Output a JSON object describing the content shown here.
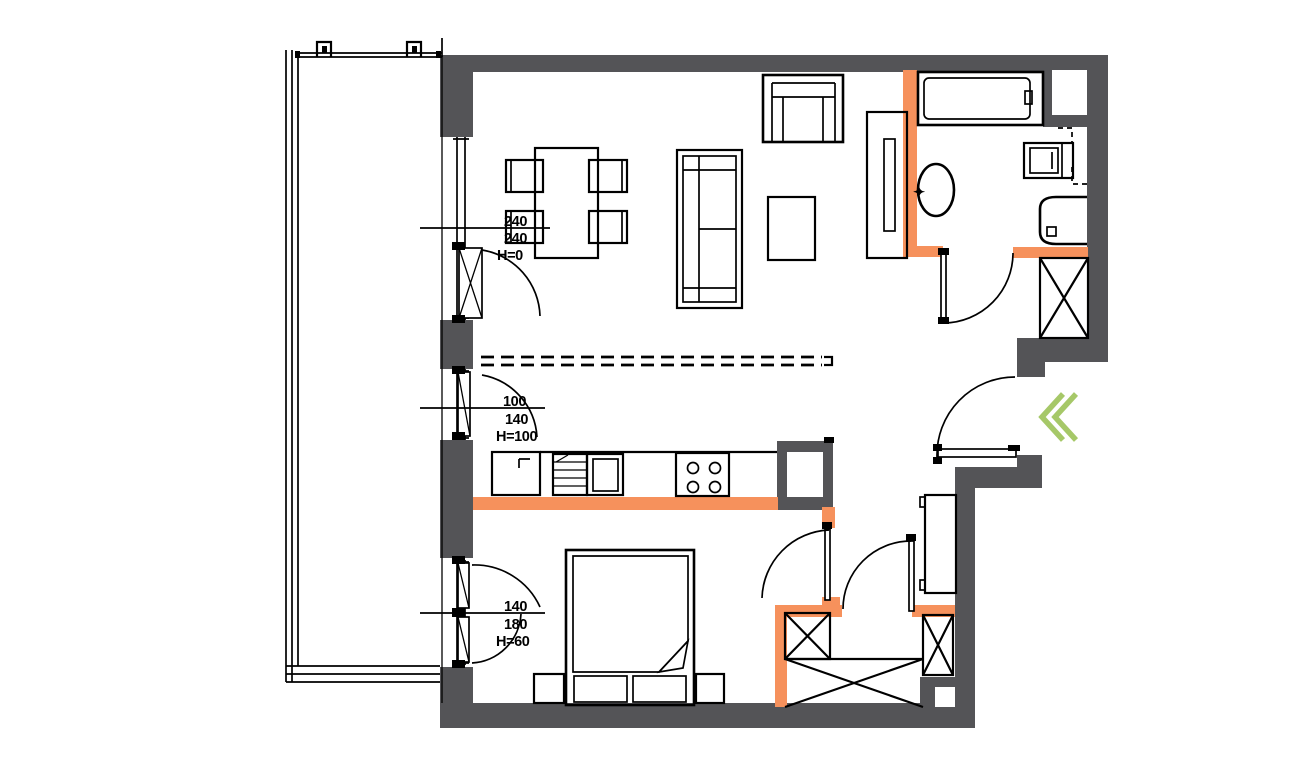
{
  "colors": {
    "wall": "#545457",
    "accent": "#f6915c",
    "chevron": "#a6c868",
    "line": "#000000",
    "bg": "#ffffff"
  },
  "annotations": {
    "balcony_door": {
      "line1": "240",
      "line2": "240",
      "line3": "H=0"
    },
    "kitchen_window": {
      "line1": "100",
      "line2": "140",
      "line3": "H=100"
    },
    "bedroom_window": {
      "line1": "140",
      "line2": "180",
      "line3": "H=60"
    }
  },
  "icons": {
    "faucet": "✦"
  }
}
